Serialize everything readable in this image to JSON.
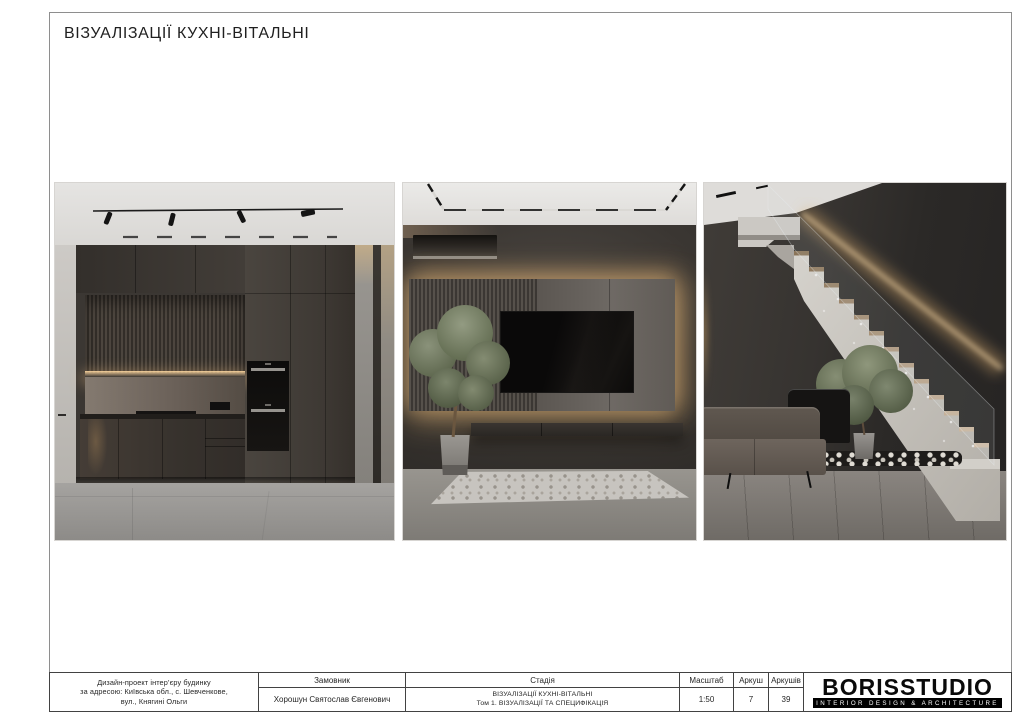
{
  "sheet": {
    "title": "ВІЗУАЛІЗАЦІЇ КУХНІ-ВІТАЛЬНІ"
  },
  "title_block": {
    "project_address": {
      "line1": "Дизайн-проект інтер’єру будинку",
      "line2": "за адресою: Київська обл., с. Шевченкове,",
      "line3": "вул., Княгині Ольги"
    },
    "customer": {
      "label": "Замовник",
      "value": "Хорошун Святослав Євгенович"
    },
    "stage": {
      "label": "Стадія",
      "line1": "ВІЗУАЛІЗАЦІЇ КУХНІ-ВІТАЛЬНІ",
      "line2": "Том 1. ВІЗУАЛІЗАЦІЇ ТА СПЕЦИФІКАЦІЯ"
    },
    "scale": {
      "label": "Масштаб",
      "value": "1:50"
    },
    "sheet_number": {
      "label": "Аркуш",
      "value": "7"
    },
    "sheets_total": {
      "label": "Аркушів",
      "value": "39"
    }
  },
  "logo": {
    "name": "BORISSTUDIO",
    "tagline": "INTERIOR DESIGN & ARCHITECTURE"
  },
  "colors": {
    "paper": "#ffffff",
    "frame_line": "#8e8e8e",
    "table_line": "#424242",
    "text": "#1f1f1f",
    "logo_bar": "#000000",
    "warm_light": "#e6c08c",
    "render_dark": "#3a3734",
    "floor_grey": "#8f8d8a"
  }
}
